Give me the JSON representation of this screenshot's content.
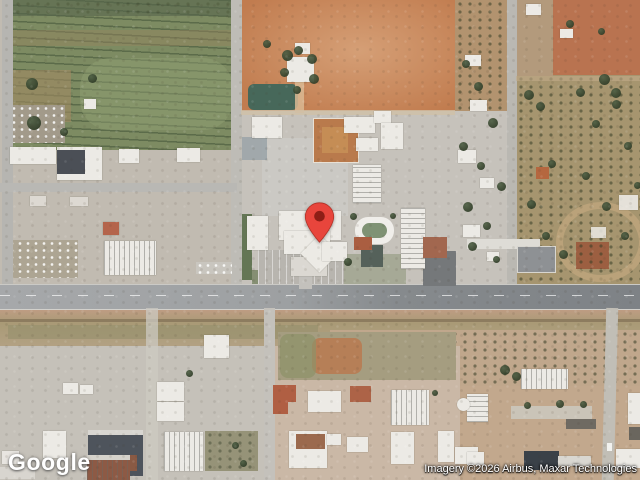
{
  "map": {
    "view_type": "satellite",
    "marker": {
      "label": "red-location-pin",
      "body_color": "#E8453C",
      "edge_color": "#B33227",
      "dot_color": "#8E1E16",
      "tip_x": 320,
      "tip_y": 243
    }
  },
  "branding": {
    "logo_text": "Google"
  },
  "attribution": {
    "text": "Imagery ©2026 Airbus, Maxar Technologies"
  },
  "palette": {
    "field_green": "#7d8b62",
    "dirt_orange": "#c6855b",
    "dirt_red": "#b97350",
    "industrial_grey": "#c6c2bb",
    "road_grey": "#b6b5b1",
    "highway_grey": "#8f9295",
    "scrub_tan": "#b3a183",
    "building_white": "#eceae5",
    "roof_dark": "#4b4f56",
    "terracotta": "#b05f43",
    "tree_green": "#37422f"
  }
}
